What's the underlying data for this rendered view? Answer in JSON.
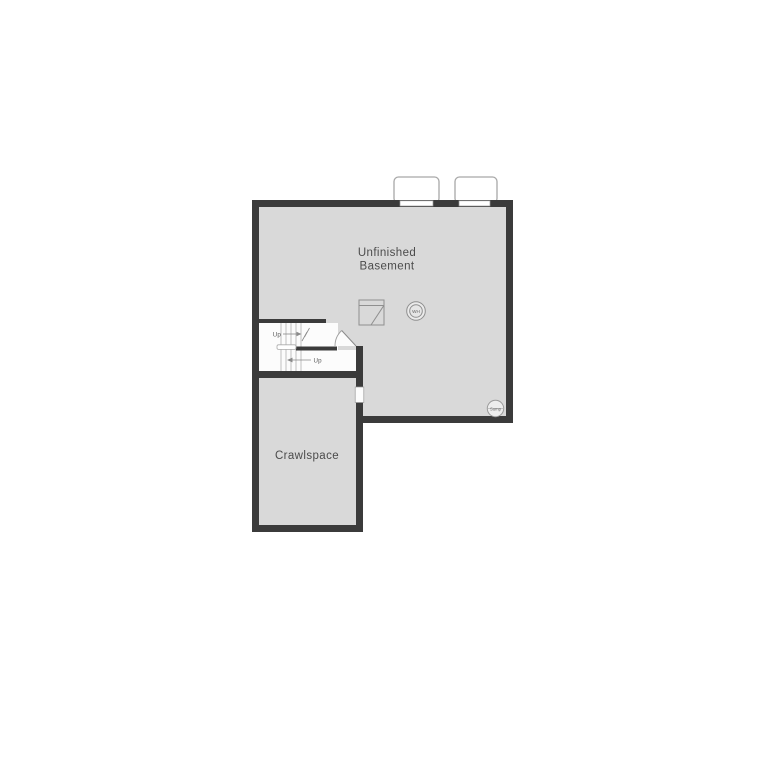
{
  "plan": {
    "title": "Basement floor plan",
    "rooms": {
      "basement": {
        "label_line1": "Unfinished",
        "label_line2": "Basement"
      },
      "crawlspace": {
        "label": "Crawlspace"
      }
    },
    "stairs": {
      "up_label_top": "Up",
      "up_label_bottom": "Up"
    },
    "fixtures": {
      "water_heater_label": "WH",
      "sump_label": "Sump",
      "furnace_icon": "furnace-icon",
      "window_well_icon": "window-well-icon",
      "door_swing_icon": "door-swing-icon",
      "stair_break_icon": "stair-break-icon"
    },
    "colors": {
      "wall": "#3b3b3b",
      "floor": "#d9d9d9",
      "stairwell": "#fcfcfc",
      "background": "#ffffff",
      "label_text": "#4b4b4b",
      "fixture_stroke": "#8f8f8f",
      "well_stroke": "#a8a8a8"
    }
  }
}
